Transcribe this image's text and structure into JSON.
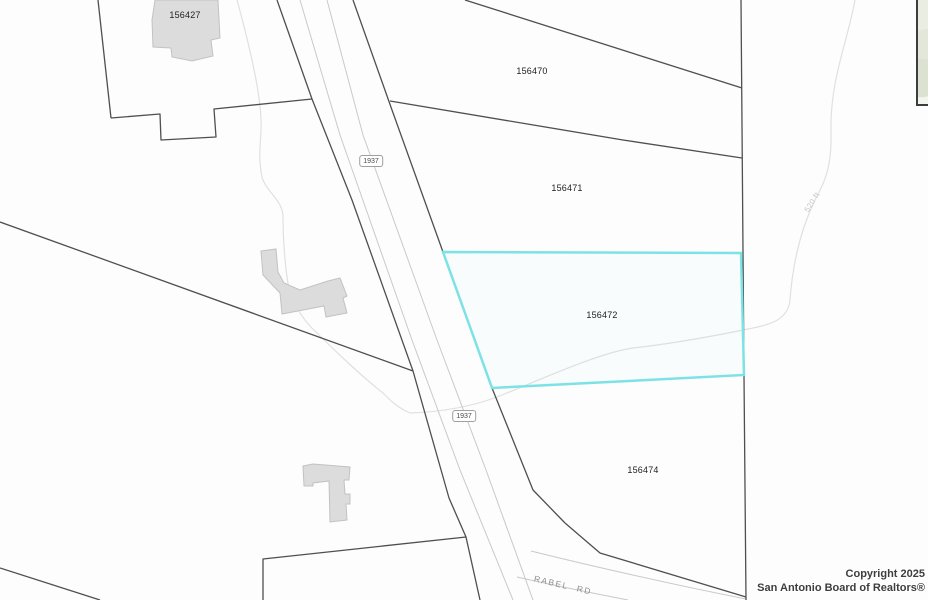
{
  "map": {
    "parcel_labels": [
      {
        "id": "156427"
      },
      {
        "id": "156470"
      },
      {
        "id": "156471"
      },
      {
        "id": "156472"
      },
      {
        "id": "156474"
      }
    ],
    "road_shields": [
      {
        "label": "1937"
      },
      {
        "label": "1937"
      }
    ],
    "street_label": "RABEL RD",
    "contour_label": "520 ft",
    "highlight_color": "#7de2e6",
    "boundary_color": "#4f4f4f",
    "pavement_line_color": "#c9c9c9",
    "stream_line_color": "#e0e0e0",
    "building_fill_color": "#dcdcdc",
    "copyright": {
      "line1": "Copyright 2025",
      "line2": "San Antonio Board of Realtors®"
    }
  }
}
